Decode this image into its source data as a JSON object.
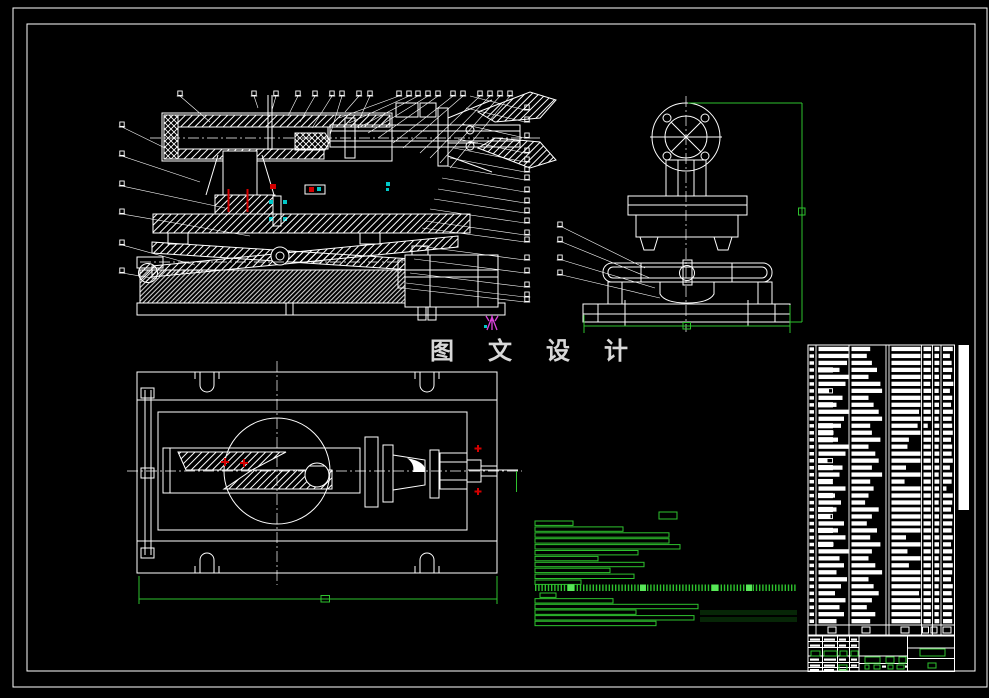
{
  "watermark": {
    "text": "图 文 设 计"
  },
  "colors": {
    "background": "#000000",
    "line": "#ffffff",
    "accent_green": "#2ec22e",
    "bright_green": "#59e659",
    "red": "#d40000",
    "magenta": "#dd44dd",
    "cyan": "#00c8c8",
    "watermark_text": "#d8d8d8"
  },
  "bom_table": {
    "row_count": 40,
    "columns": 7,
    "rows": [
      [
        1.0,
        0.55,
        1.0,
        0.9,
        0.8,
        0.85,
        0
      ],
      [
        1.0,
        0.45,
        1.0,
        0.85,
        0.75,
        0.6,
        0
      ],
      [
        0.95,
        0.6,
        1.0,
        0.9,
        0.8,
        0.75,
        0
      ],
      [
        0.7,
        0.75,
        1.0,
        0.85,
        0.7,
        0.8,
        1
      ],
      [
        1.0,
        0.5,
        1.0,
        0.9,
        0.75,
        0.7,
        0
      ],
      [
        0.9,
        0.85,
        1.0,
        0.8,
        0.8,
        0.9,
        0
      ],
      [
        0.35,
        0.9,
        1.0,
        0.9,
        0.7,
        0.6,
        1
      ],
      [
        0.8,
        0.5,
        1.0,
        0.85,
        0.8,
        0.8,
        0
      ],
      [
        0.6,
        0.65,
        1.0,
        0.9,
        0.75,
        0.7,
        1
      ],
      [
        1.0,
        0.8,
        0.95,
        0.85,
        0.8,
        0.85,
        0
      ],
      [
        0.85,
        0.9,
        1.0,
        0.9,
        0.7,
        0.75,
        0
      ],
      [
        0.75,
        0.55,
        0.9,
        0.5,
        0.8,
        0.8,
        1
      ],
      [
        0.5,
        0.6,
        1.0,
        0.9,
        0.75,
        0.85,
        1
      ],
      [
        0.65,
        0.85,
        0.6,
        0.9,
        0.8,
        0.7,
        1
      ],
      [
        1.0,
        0.5,
        0.55,
        0.85,
        0.7,
        0.8,
        0
      ],
      [
        0.9,
        0.7,
        1.0,
        0.9,
        0.8,
        0.75,
        0
      ],
      [
        0.3,
        0.8,
        1.0,
        0.85,
        0.75,
        0.85,
        1
      ],
      [
        0.8,
        0.6,
        0.5,
        0.9,
        0.8,
        0.6,
        1
      ],
      [
        0.7,
        0.9,
        1.0,
        0.9,
        0.7,
        0.8,
        0
      ],
      [
        0.45,
        0.55,
        0.45,
        0.85,
        0.8,
        0.75,
        1
      ],
      [
        0.9,
        0.65,
        1.0,
        0.9,
        0.75,
        0.3,
        0
      ],
      [
        0.55,
        0.5,
        1.0,
        0.85,
        0.8,
        0.85,
        1
      ],
      [
        0.75,
        0.4,
        1.0,
        0.9,
        0.7,
        0.8,
        0
      ],
      [
        0.6,
        0.8,
        1.0,
        0.85,
        0.8,
        0.7,
        1
      ],
      [
        0.4,
        0.6,
        1.0,
        0.9,
        0.75,
        0.85,
        1
      ],
      [
        0.85,
        0.45,
        1.0,
        0.85,
        0.8,
        0.8,
        0
      ],
      [
        0.65,
        0.75,
        1.0,
        0.9,
        0.7,
        0.75,
        1
      ],
      [
        0.9,
        0.55,
        0.5,
        0.85,
        0.8,
        0.85,
        0
      ],
      [
        0.5,
        0.85,
        1.0,
        0.9,
        0.75,
        0.7,
        1
      ],
      [
        1.0,
        0.6,
        0.55,
        0.85,
        0.8,
        0.8,
        0
      ],
      [
        0.7,
        0.5,
        1.0,
        0.9,
        0.7,
        0.75,
        0
      ],
      [
        0.85,
        0.7,
        0.6,
        0.85,
        0.8,
        0.85,
        0
      ],
      [
        0.6,
        0.9,
        1.0,
        0.9,
        0.75,
        0.8,
        0
      ],
      [
        0.95,
        0.5,
        1.0,
        0.85,
        0.8,
        0.7,
        0
      ],
      [
        0.75,
        0.65,
        1.0,
        0.9,
        0.7,
        0.85,
        0
      ],
      [
        0.55,
        0.8,
        0.95,
        0.85,
        0.8,
        0.75,
        0
      ],
      [
        0.9,
        0.6,
        1.0,
        0.9,
        0.75,
        0.8,
        0
      ],
      [
        0.7,
        0.45,
        1.0,
        0.85,
        0.8,
        0.85,
        0
      ],
      [
        0.85,
        0.7,
        1.0,
        0.9,
        0.7,
        0.75,
        0
      ],
      [
        0.6,
        0.55,
        1.0,
        0.85,
        0.8,
        0.8,
        0
      ]
    ]
  },
  "notes_block": {
    "bars_top": [
      38,
      88,
      134,
      134,
      145,
      103,
      63,
      109,
      75,
      99,
      46
    ],
    "bars_bottom": [
      {
        "w": 16,
        "dx": 5
      },
      {
        "w": 78,
        "dx": 0
      },
      {
        "w": 163,
        "dx": 0
      },
      {
        "w": 101,
        "dx": 0
      },
      {
        "w": 159,
        "dx": 0
      },
      {
        "w": 121,
        "dx": 0
      }
    ],
    "chip_width": 18
  }
}
